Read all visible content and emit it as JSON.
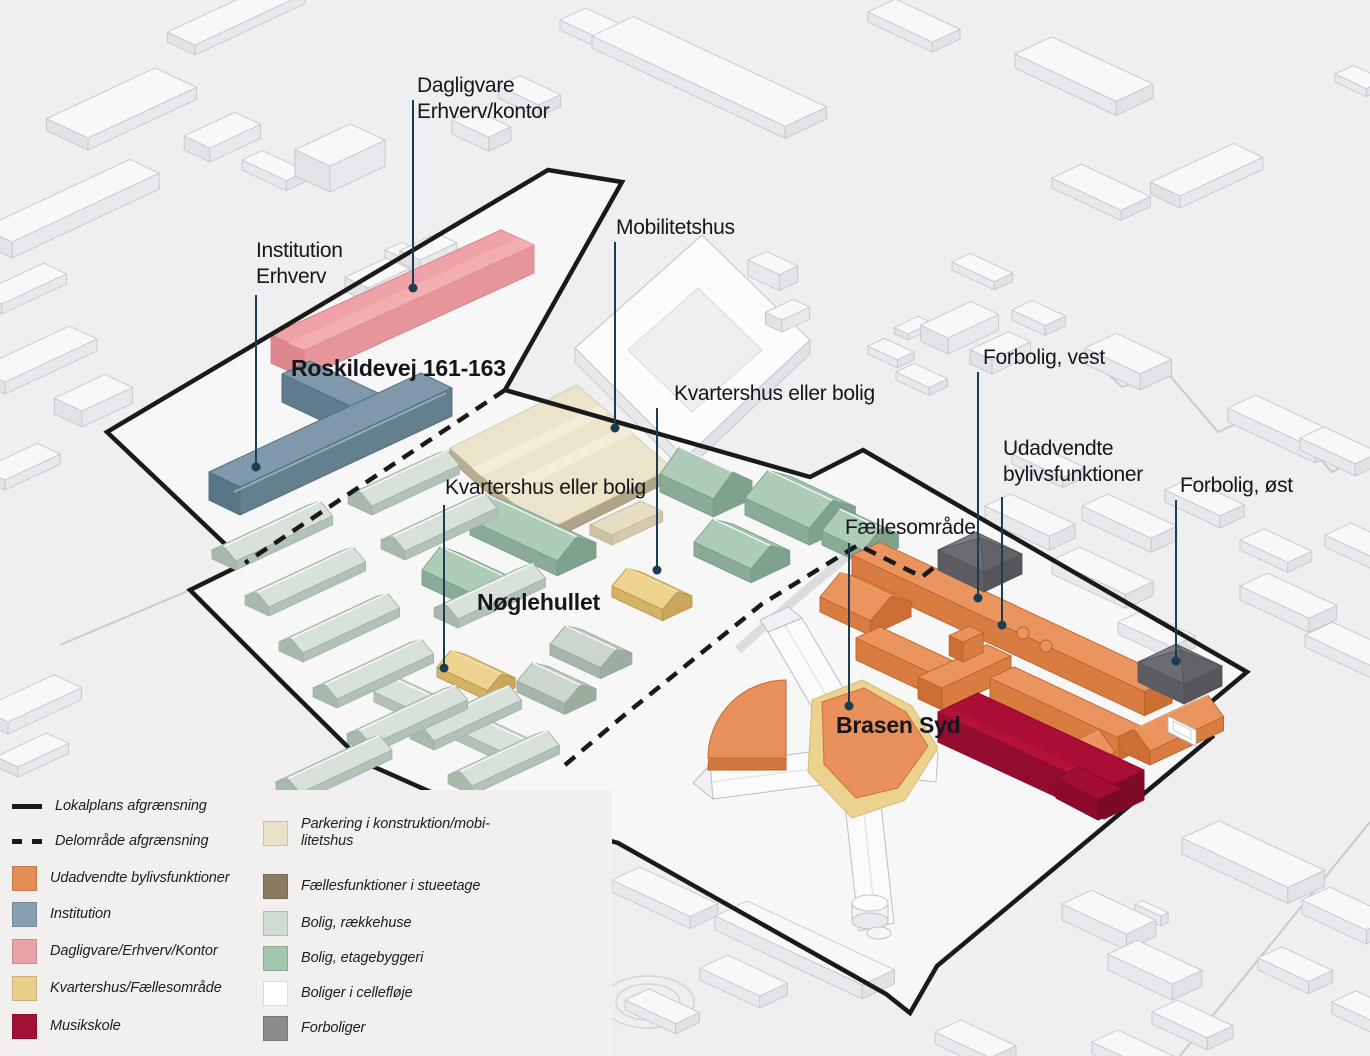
{
  "map": {
    "areas": {
      "roskildevej": "Roskildevej 161-163",
      "noeglehullet": "Nøglehullet",
      "brasen_syd": "Brasen Syd"
    },
    "callouts": {
      "dagligvare": "Dagligvare\nErhverv/kontor",
      "institution": "Institution\nErhverv",
      "mobilitetshus": "Mobilitetshus",
      "kvartershus_nord": "Kvartershus eller bolig",
      "kvartershus_syd": "Kvartershus eller bolig",
      "forbolig_vest": "Forbolig, vest",
      "udadvendte": "Udadvendte\nbylivsfunktioner",
      "forbolig_oest": "Forbolig, øst",
      "faellesomraade": "Fællesområde"
    }
  },
  "legend": {
    "left": [
      {
        "swatch": "line-solid",
        "color": "#1a1a1a",
        "label": "Lokalplans afgrænsning"
      },
      {
        "swatch": "line-dashed",
        "color": "#1a1a1a",
        "label": "Delområde afgrænsning"
      },
      {
        "swatch": "fill",
        "color": "#e58d58",
        "label": "Udadvendte bylivsfunktioner"
      },
      {
        "swatch": "fill",
        "color": "#87a0b0",
        "label": "Institution"
      },
      {
        "swatch": "fill",
        "color": "#eaa3a9",
        "label": "Dagligvare/Erhverv/Kontor"
      },
      {
        "swatch": "fill",
        "color": "#e9cf8a",
        "label": "Kvartershus/Fællesområde"
      },
      {
        "swatch": "fill",
        "color": "#a31036",
        "label": "Musikskole"
      }
    ],
    "right": [
      {
        "swatch": "fill",
        "color": "#e9e2c9",
        "label": "Parkering i konstruktion/mobi-\nlitetshus"
      },
      {
        "swatch": "fill",
        "color": "#8a7a60",
        "label": "Fællesfunktioner i stueetage"
      },
      {
        "swatch": "fill",
        "color": "#cfdcd2",
        "label": "Bolig, rækkehuse"
      },
      {
        "swatch": "fill",
        "color": "#a4c7b0",
        "label": "Bolig, etagebyggeri"
      },
      {
        "swatch": "fill",
        "color": "#ffffff",
        "label": "Boliger i cellefløje"
      },
      {
        "swatch": "fill",
        "color": "#8b8b8b",
        "label": "Forboliger"
      }
    ]
  },
  "colors": {
    "ground": "#efeff1",
    "parcel_fill": "#f7f7f8",
    "boundary": "#1a1a1a",
    "callout_line": "#1c3c52",
    "udadvendte_bylivsfunktioner": "#e58d58",
    "institution": "#87a0b0",
    "dagligvare_erhverv_kontor": "#eaa3a9",
    "kvartershus_faellesomraade": "#e9cf8a",
    "musikskole": "#a31036",
    "parkering_mobilitetshus": "#e9e2c9",
    "faellesfunktioner_stueetage": "#8a7a60",
    "bolig_raekkehuse": "#cfdcd2",
    "bolig_etagebyggeri": "#a4c7b0",
    "boliger_cellefloeje": "#ffffff",
    "forboliger": "#8b8b8b",
    "legend_bg": "#f2f0ee"
  }
}
